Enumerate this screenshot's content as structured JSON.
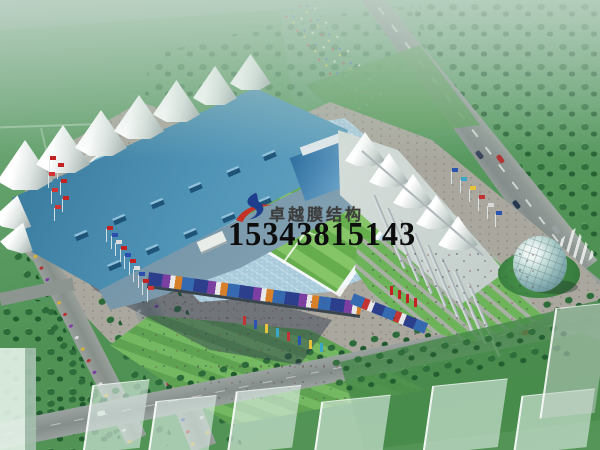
{
  "watermark": {
    "brand": "卓越膜结构",
    "phone": "15343815143",
    "brand_color": "#3c3c3c",
    "phone_color": "#0d0d0d",
    "logo": "brush-swoosh-logo",
    "logo_colors": {
      "swoosh_blue": "#1d3e8c",
      "brush_red": "#c53326"
    }
  },
  "scene": {
    "subject": "aerial rendering of a membrane-roof stadium complex",
    "palette": {
      "haze_green": "#8fb49b",
      "field_green": "#5b9c64",
      "forest_green": "#2d6b3a",
      "pitch_green_light": "#86c468",
      "pitch_green_dark": "#66ad4e",
      "roof_blue": "#4f93b6",
      "membrane_white": "#f2f4f0",
      "seating_blue": "#a9cbdc",
      "plaza_gray": "#aaa89e",
      "road_gray": "#8d9693",
      "shadow_blue": "#2d374b",
      "fountain_blue": "#5aa0c8",
      "flag_red": "#c22222",
      "sphere_glass": "#bcd8d4"
    }
  }
}
